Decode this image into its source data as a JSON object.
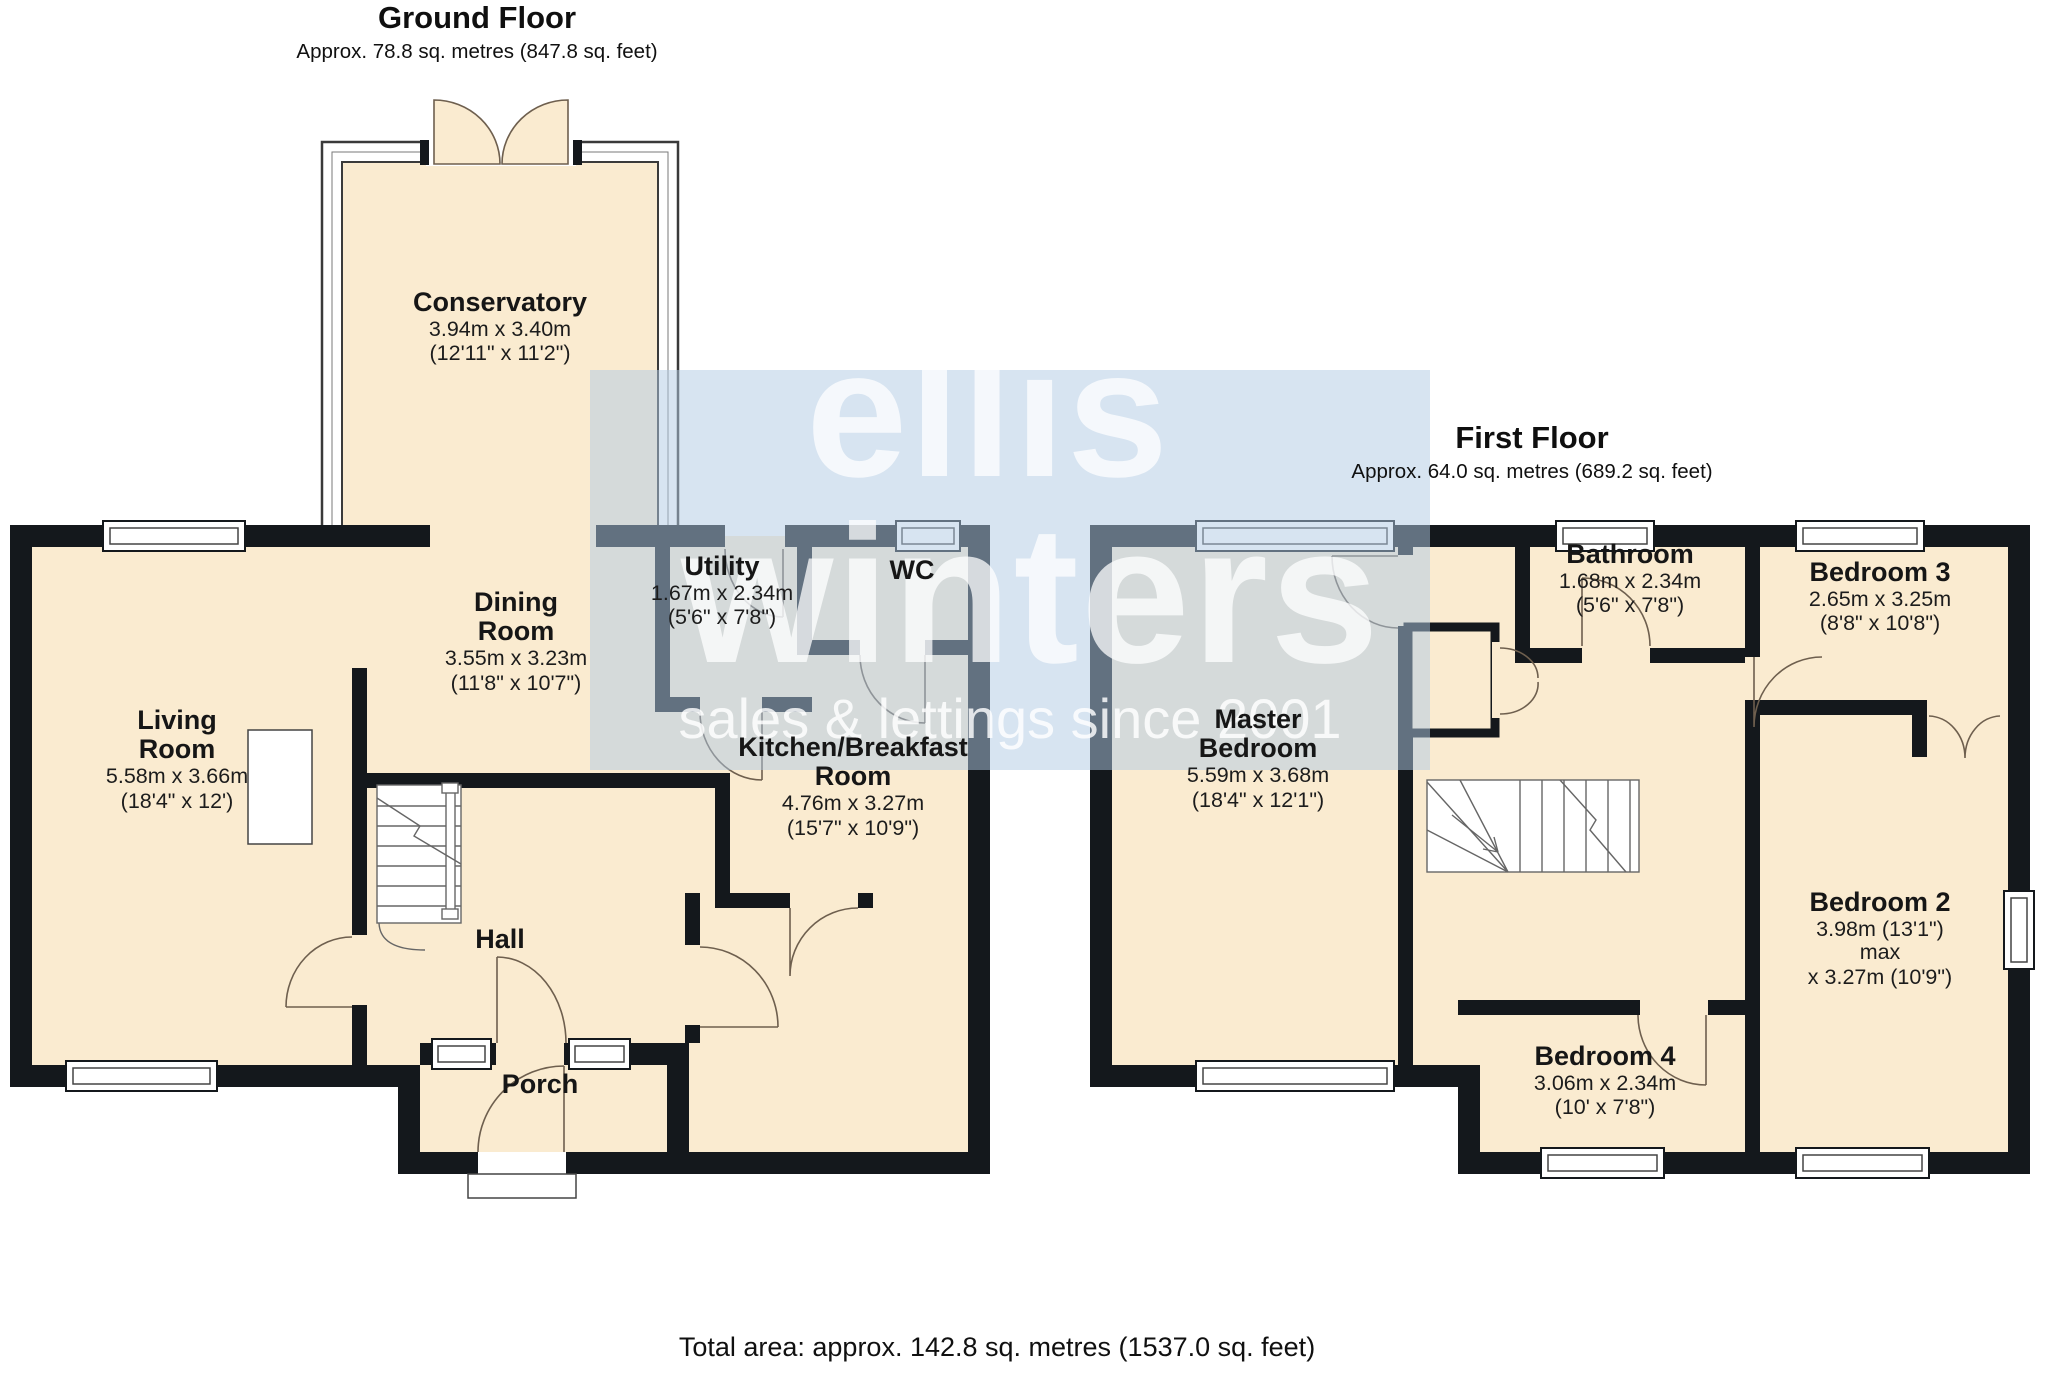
{
  "ground_floor": {
    "title": "Ground Floor",
    "subtitle": "Approx. 78.8 sq. metres (847.8 sq. feet)",
    "rooms": [
      {
        "name": "Conservatory",
        "dims_m": "3.94m x 3.40m",
        "dims_ft": "(12'11\" x 11'2\")"
      },
      {
        "name": "Dining Room",
        "dims_m": "3.55m x 3.23m",
        "dims_ft": "(11'8\" x 10'7\")"
      },
      {
        "name": "Living Room",
        "dims_m": "5.58m x 3.66m",
        "dims_ft": "(18'4\" x 12')"
      },
      {
        "name": "Utility",
        "dims_m": "1.67m x 2.34m",
        "dims_ft": "(5'6\" x 7'8\")"
      },
      {
        "name": "WC"
      },
      {
        "name": "Kitchen/Breakfast Room",
        "dims_m": "4.76m x 3.27m",
        "dims_ft": "(15'7\" x 10'9\")"
      },
      {
        "name": "Hall"
      },
      {
        "name": "Porch"
      }
    ]
  },
  "first_floor": {
    "title": "First Floor",
    "subtitle": "Approx. 64.0 sq. metres (689.2 sq. feet)",
    "rooms": [
      {
        "name": "Master Bedroom",
        "dims_m": "5.59m x 3.68m",
        "dims_ft": "(18'4\" x 12'1\")"
      },
      {
        "name": "Bathroom",
        "dims_m": "1.68m x 2.34m",
        "dims_ft": "(5'6\" x 7'8\")"
      },
      {
        "name": "Bedroom 3",
        "dims_m": "2.65m x 3.25m",
        "dims_ft": "(8'8\" x 10'8\")"
      },
      {
        "name": "Bedroom 2",
        "dims_m": "3.98m (13'1\") max",
        "dims_ft": "x 3.27m (10'9\")"
      },
      {
        "name": "Bedroom 4",
        "dims_m": "3.06m x 2.34m",
        "dims_ft": "(10' x 7'8\")"
      }
    ]
  },
  "watermark": {
    "line1": "ellis",
    "line2": "winters",
    "tagline": "sales & lettings since 2001"
  },
  "footer": {
    "total_area": "Total area: approx. 142.8 sq. metres (1537.0 sq. feet)"
  },
  "colors": {
    "room_fill": "#FAEBD0",
    "wall": "#14181c",
    "watermark_tint": "#AFCAE4",
    "door_arc": "#6e5f4e"
  }
}
